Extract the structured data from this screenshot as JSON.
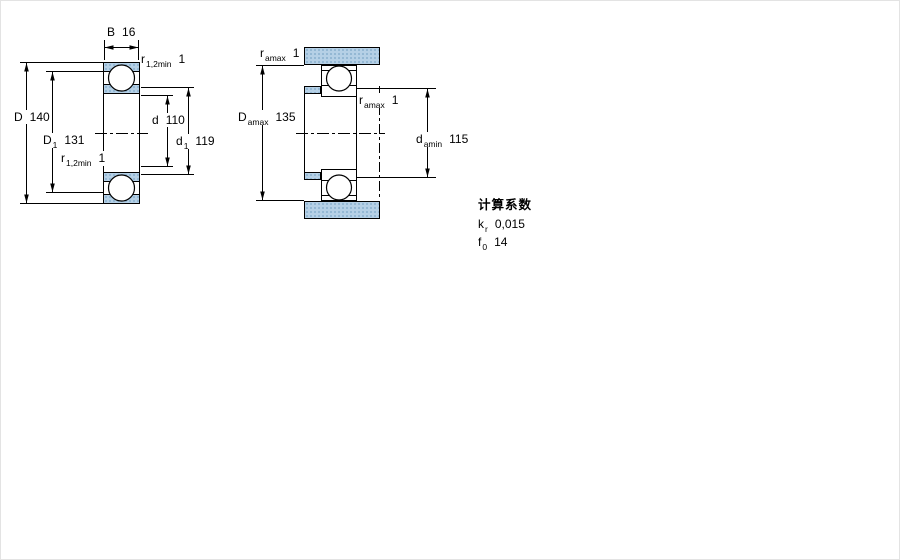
{
  "page": {
    "background": "#ffffff",
    "frame_color": "#e3e3e3"
  },
  "colors": {
    "steel_fill": "#b5d0e6",
    "steel_dot": "#7ea7c7",
    "line": "#000000",
    "text": "#000000"
  },
  "left_drawing": {
    "name": "bearing-cross-section",
    "dims": {
      "B": {
        "label": "B",
        "value": "16"
      },
      "D": {
        "label": "D",
        "value": "140"
      },
      "D1": {
        "label": "D",
        "sub": "1",
        "value": "131"
      },
      "d": {
        "label": "d",
        "value": "110"
      },
      "d1": {
        "label": "d",
        "sub": "1",
        "value": "119"
      },
      "r_top": {
        "label": "r",
        "sub": "1,2min",
        "value": "1"
      },
      "r_bottom": {
        "label": "r",
        "sub": "1,2min",
        "value": "1"
      }
    }
  },
  "right_drawing": {
    "name": "abutment-fillet-dimensions",
    "dims": {
      "ra_top": {
        "label": "r",
        "sub": "amax",
        "value": "1"
      },
      "Da": {
        "label": "D",
        "sub": "amax",
        "value": "135"
      },
      "ra_mid": {
        "label": "r",
        "sub": "amax",
        "value": "1"
      },
      "da": {
        "label": "d",
        "sub": "amin",
        "value": "115"
      }
    }
  },
  "calculation_factors": {
    "title": "计算系数",
    "items": [
      {
        "label": "k",
        "sub": "r",
        "value": "0,015"
      },
      {
        "label": "f",
        "sub": "0",
        "value": "14"
      }
    ]
  }
}
